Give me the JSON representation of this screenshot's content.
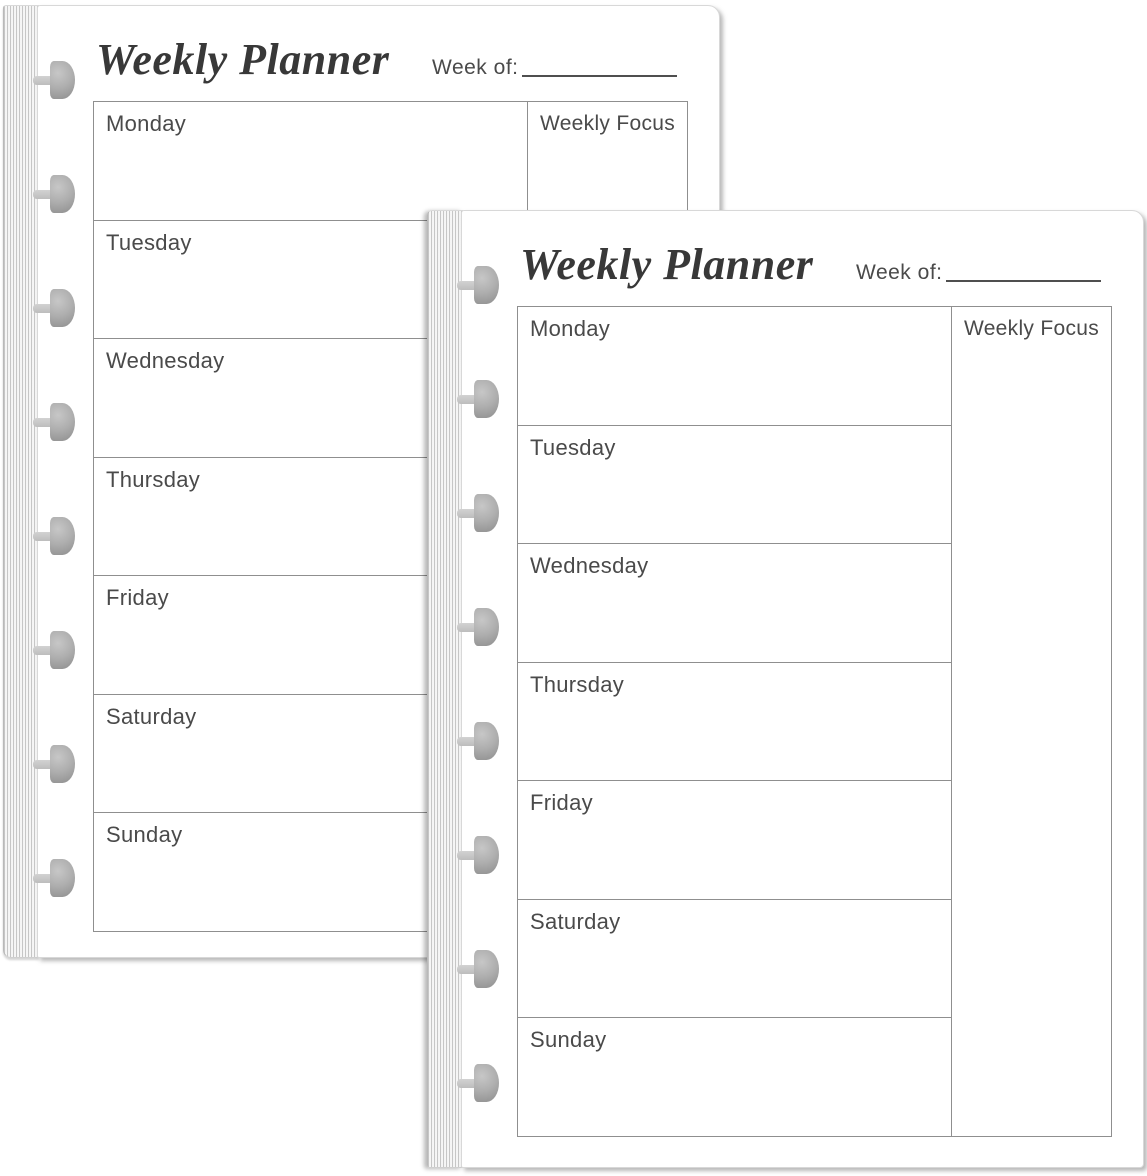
{
  "page": {
    "title": "Weekly Planner",
    "week_of_label": "Week of:",
    "weekly_focus_label": "Weekly Focus",
    "days": [
      "Monday",
      "Tuesday",
      "Wednesday",
      "Thursday",
      "Friday",
      "Saturday",
      "Sunday"
    ]
  },
  "colors": {
    "paper": "#ffffff",
    "table_border": "#8f8f8f",
    "day_text": "#4a4a4a",
    "title_text": "#383838",
    "disc_gray": "#9a9a9a",
    "spine_stripe": "#c6c6c6"
  }
}
